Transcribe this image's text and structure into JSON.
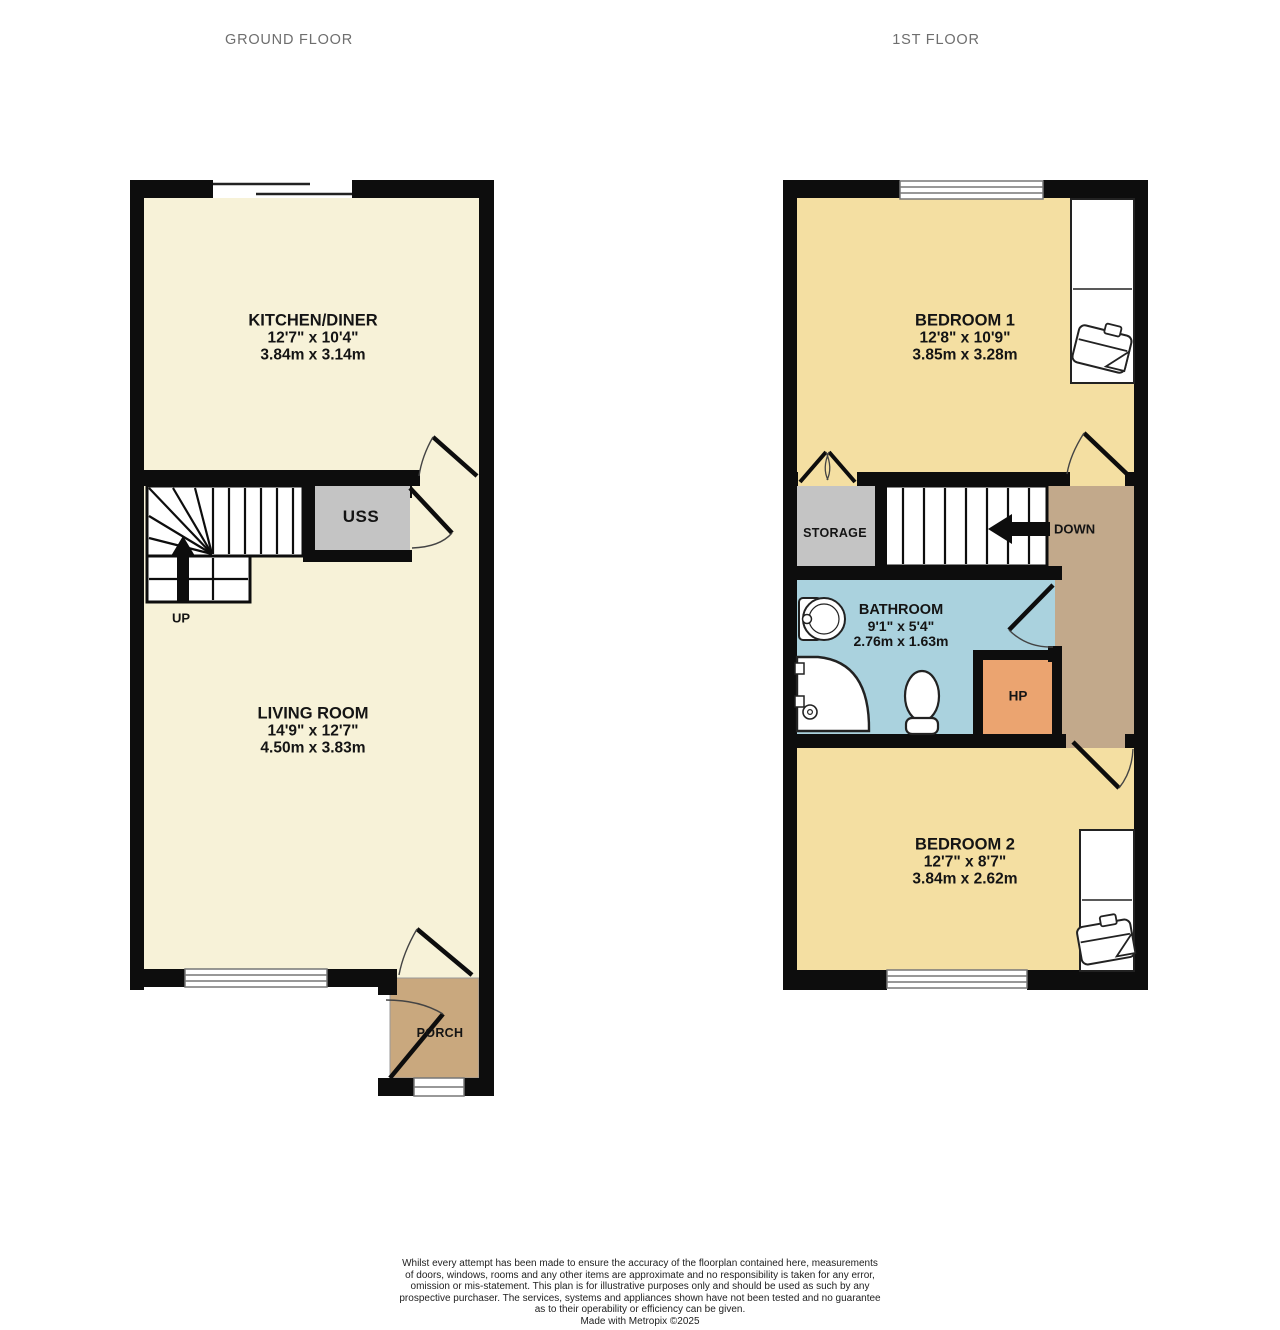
{
  "page": {
    "background": "#ffffff"
  },
  "colors": {
    "wall": "#0d0d0d",
    "room_cream": "#f7f2d8",
    "room_yellow": "#f4dfa2",
    "landing_tan": "#c2a98b",
    "porch_tan": "#c9a87e",
    "bathroom_blue": "#aad2de",
    "storage_gray": "#c4c4c4",
    "hp_orange": "#eba470"
  },
  "ground_floor": {
    "title": "GROUND FLOOR",
    "kitchen": {
      "name": "KITCHEN/DINER",
      "dims_imperial": "12'7\" x 10'4\"",
      "dims_metric": "3.84m x 3.14m"
    },
    "living_room": {
      "name": "LIVING ROOM",
      "dims_imperial": "14'9\" x 12'7\"",
      "dims_metric": "4.50m x 3.83m"
    },
    "uss": {
      "name": "USS"
    },
    "porch": {
      "name": "PORCH"
    },
    "stairs_label": "UP"
  },
  "first_floor": {
    "title": "1ST FLOOR",
    "bedroom1": {
      "name": "BEDROOM 1",
      "dims_imperial": "12'8\" x 10'9\"",
      "dims_metric": "3.85m x 3.28m"
    },
    "bedroom2": {
      "name": "BEDROOM 2",
      "dims_imperial": "12'7\" x 8'7\"",
      "dims_metric": "3.84m x 2.62m"
    },
    "bathroom": {
      "name": "BATHROOM",
      "dims_imperial": "9'1\" x 5'4\"",
      "dims_metric": "2.76m x 1.63m"
    },
    "storage": {
      "name": "STORAGE"
    },
    "hp": {
      "name": "HP"
    },
    "stairs_label": "DOWN"
  },
  "footer": {
    "lines": [
      "Whilst every attempt has been made to ensure the accuracy of the floorplan contained here, measurements",
      "of doors, windows, rooms and any other items are approximate and no responsibility is taken for any error,",
      "omission or mis-statement. This plan is for illustrative purposes only and should be used as such by any",
      "prospective purchaser. The services, systems and appliances shown have not been tested and no guarantee",
      "as to their operability or efficiency can be given."
    ],
    "credit": "Made with Metropix ©2025"
  }
}
